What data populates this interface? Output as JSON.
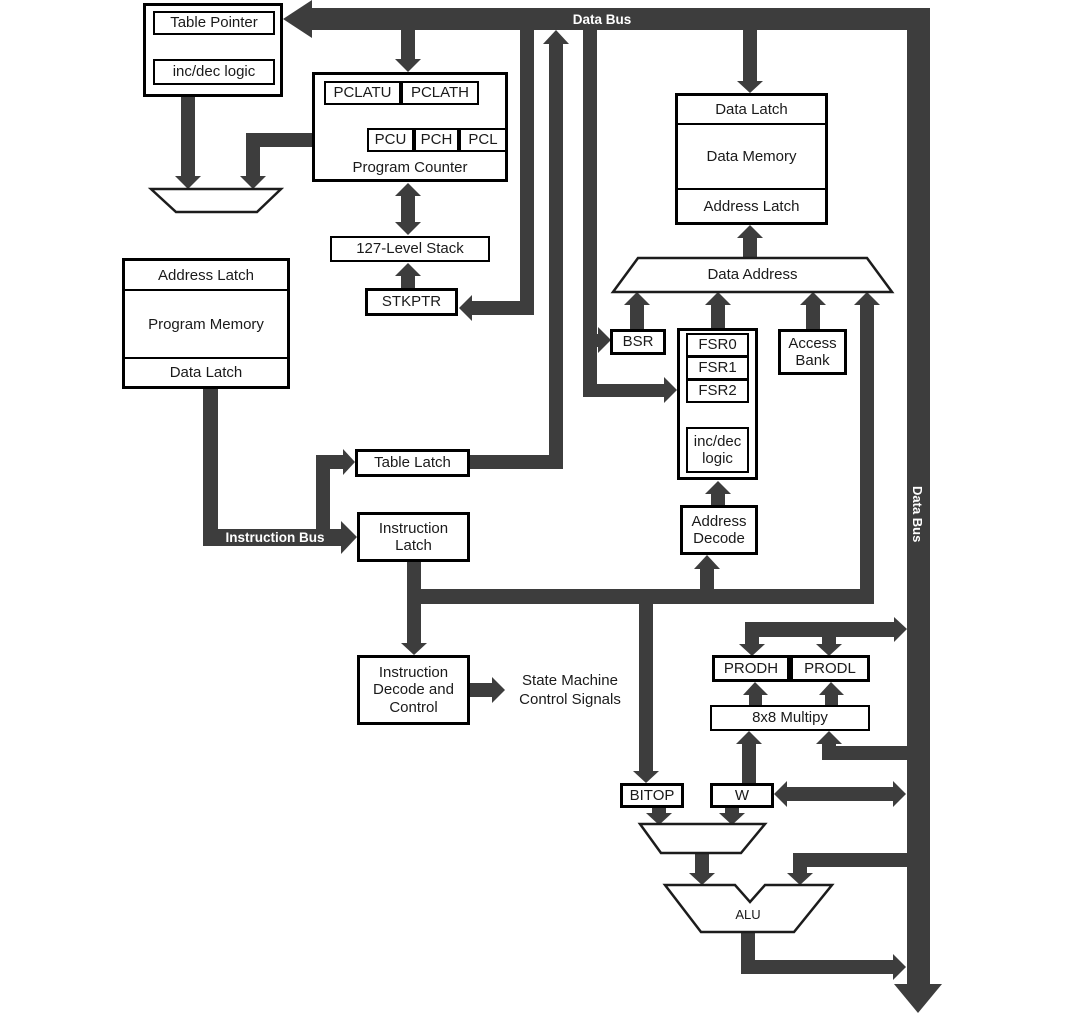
{
  "colors": {
    "bus": "#3d3d3d",
    "box_border": "#000000",
    "box_fill": "#ffffff",
    "text": "#1a1a1a",
    "bus_label": "#ffffff"
  },
  "buses": {
    "top_data_bus": "Data Bus",
    "right_data_bus": "Data Bus",
    "instruction_bus": "Instruction Bus"
  },
  "blocks": {
    "table_pointer": "Table Pointer",
    "inc_dec_logic_top": "inc/dec logic",
    "pclatu": "PCLATU",
    "pclath": "PCLATH",
    "pcu": "PCU",
    "pch": "PCH",
    "pcl": "PCL",
    "program_counter": "Program Counter",
    "stack": "127-Level Stack",
    "stkptr": "STKPTR",
    "prog_address_latch": "Address Latch",
    "program_memory": "Program Memory",
    "prog_data_latch": "Data Latch",
    "mem_data_latch": "Data Latch",
    "data_memory": "Data Memory",
    "mem_address_latch": "Address Latch",
    "data_address": "Data Address",
    "bsr": "BSR",
    "fsr0": "FSR0",
    "fsr1": "FSR1",
    "fsr2": "FSR2",
    "inc_dec_logic_fsr": "inc/dec logic",
    "access_bank": "Access Bank",
    "address_decode": "Address Decode",
    "table_latch": "Table Latch",
    "instruction_latch": "Instruction Latch",
    "instruction_decode": "Instruction Decode and Control",
    "state_machine": "State Machine Control Signals",
    "prodh": "PRODH",
    "prodl": "PRODL",
    "multiply": "8x8 Multipy",
    "bitop": "BITOP",
    "w_reg": "W",
    "alu": "ALU"
  }
}
